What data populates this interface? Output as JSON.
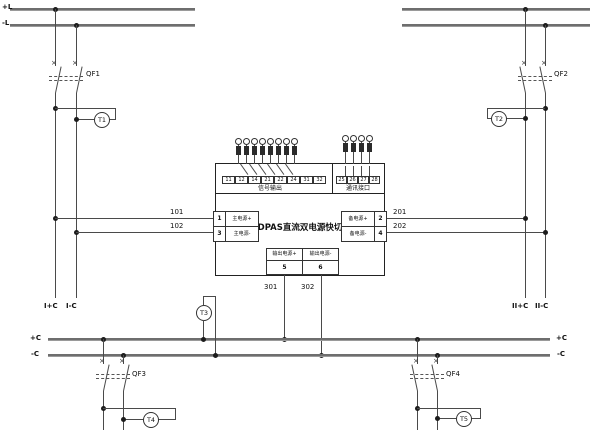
{
  "buses": {
    "top_pos": "+L",
    "top_neg": "-L",
    "ctrl_pos_left": "+C",
    "ctrl_neg_left": "-C",
    "ctrl_pos_right": "+C",
    "ctrl_neg_right": "-C"
  },
  "breakers": {
    "qf1": "QF1",
    "qf2": "QF2",
    "qf3": "QF3",
    "qf4": "QF4"
  },
  "meters": {
    "t1": "T1",
    "t2": "T2",
    "t3": "T3",
    "t4": "T4",
    "t5": "T5"
  },
  "wire_labels": {
    "w101": "101",
    "w102": "102",
    "w201": "201",
    "w202": "202",
    "w301": "301",
    "w302": "302"
  },
  "tails": {
    "sec1_pos": "I+C",
    "sec1_neg": "I-C",
    "sec2_pos": "II+C",
    "sec2_neg": "II-C"
  },
  "module": {
    "title": "DPAS直流双电源快切",
    "signal_section": "信号输出",
    "comm_section": "通讯接口",
    "signal_cells": [
      "11",
      "12",
      "14",
      "21",
      "22",
      "24",
      "31",
      "32"
    ],
    "comm_cells": [
      "25",
      "26",
      "27",
      "28"
    ],
    "main_input": [
      {
        "num": "1",
        "label": "主电源+"
      },
      {
        "num": "3",
        "label": "主电源-"
      }
    ],
    "backup_input": [
      {
        "num": "2",
        "label": "备电源+"
      },
      {
        "num": "4",
        "label": "备电源-"
      }
    ],
    "output": [
      {
        "num": "5",
        "label": "输出电源+"
      },
      {
        "num": "6",
        "label": "输出电源-"
      }
    ]
  },
  "colors": {
    "wire": "#4a4a4a",
    "bus": "#6e6e6e",
    "text": "#111111",
    "background": "#ffffff"
  }
}
